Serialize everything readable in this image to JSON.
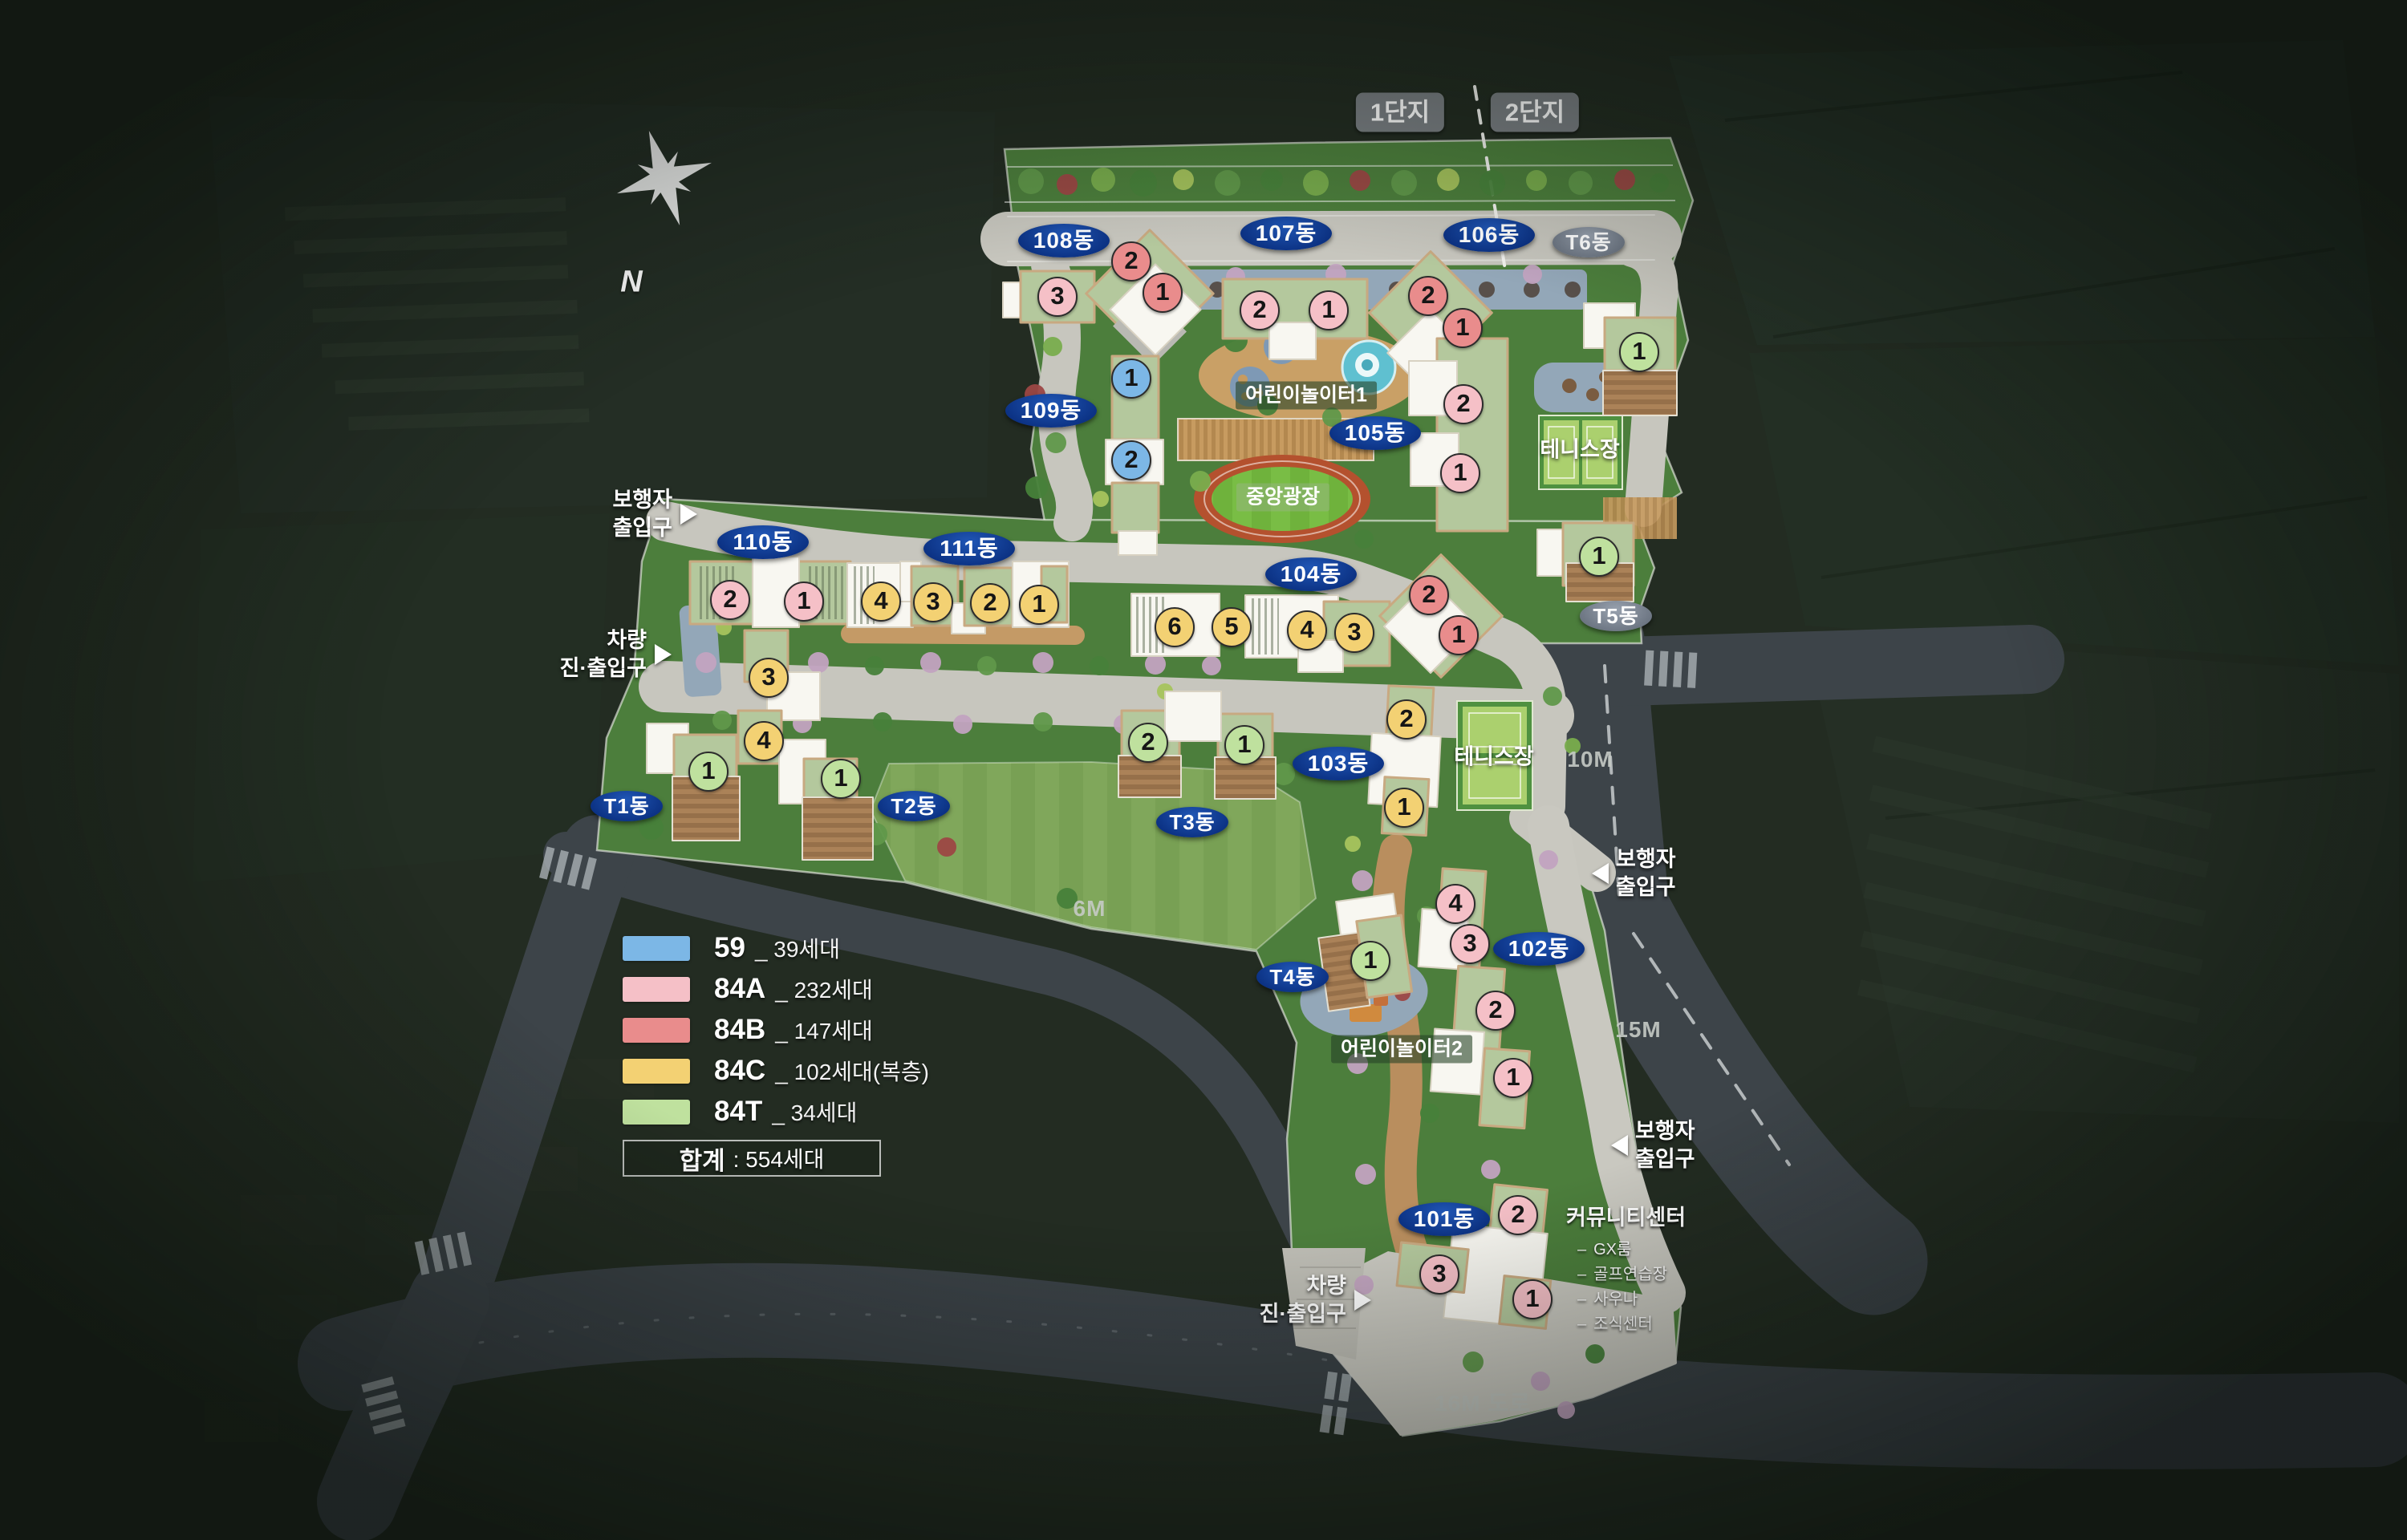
{
  "complex_tags": {
    "tag1": "1단지",
    "tag2": "2단지"
  },
  "compass": {
    "north": "N"
  },
  "buildings": [
    {
      "label": "101동",
      "units": [
        {
          "n": "2",
          "t": "84A"
        },
        {
          "n": "3",
          "t": "84A"
        },
        {
          "n": "1",
          "t": "84A"
        }
      ]
    },
    {
      "label": "102동",
      "units": [
        {
          "n": "4",
          "t": "84A"
        },
        {
          "n": "3",
          "t": "84A"
        },
        {
          "n": "2",
          "t": "84A"
        },
        {
          "n": "1",
          "t": "84A"
        }
      ]
    },
    {
      "label": "103동",
      "units": [
        {
          "n": "2",
          "t": "84C"
        },
        {
          "n": "1",
          "t": "84C"
        }
      ]
    },
    {
      "label": "104동",
      "units": [
        {
          "n": "6",
          "t": "84C"
        },
        {
          "n": "5",
          "t": "84C"
        },
        {
          "n": "4",
          "t": "84C"
        },
        {
          "n": "3",
          "t": "84C"
        },
        {
          "n": "2",
          "t": "84B"
        },
        {
          "n": "1",
          "t": "84B"
        }
      ]
    },
    {
      "label": "105동",
      "units": [
        {
          "n": "2",
          "t": "84A"
        },
        {
          "n": "1",
          "t": "84A"
        }
      ]
    },
    {
      "label": "106동",
      "units": [
        {
          "n": "2",
          "t": "84B"
        },
        {
          "n": "1",
          "t": "84B"
        }
      ]
    },
    {
      "label": "107동",
      "units": [
        {
          "n": "2",
          "t": "84A"
        },
        {
          "n": "1",
          "t": "84A"
        }
      ]
    },
    {
      "label": "108동",
      "units": [
        {
          "n": "3",
          "t": "84A"
        },
        {
          "n": "2",
          "t": "84B"
        },
        {
          "n": "1",
          "t": "84B"
        }
      ]
    },
    {
      "label": "109동",
      "units": [
        {
          "n": "1",
          "t": "59"
        },
        {
          "n": "2",
          "t": "59"
        }
      ]
    },
    {
      "label": "110동",
      "units": [
        {
          "n": "2",
          "t": "84A"
        },
        {
          "n": "1",
          "t": "84A"
        },
        {
          "n": "3",
          "t": "84C"
        },
        {
          "n": "4",
          "t": "84C"
        }
      ]
    },
    {
      "label": "111동",
      "units": [
        {
          "n": "4",
          "t": "84C"
        },
        {
          "n": "3",
          "t": "84C"
        },
        {
          "n": "2",
          "t": "84C"
        },
        {
          "n": "1",
          "t": "84C"
        }
      ]
    },
    {
      "label": "T1동",
      "units": [
        {
          "n": "1",
          "t": "84T"
        }
      ]
    },
    {
      "label": "T2동",
      "units": [
        {
          "n": "1",
          "t": "84T"
        }
      ]
    },
    {
      "label": "T3동",
      "units": [
        {
          "n": "2",
          "t": "84T"
        },
        {
          "n": "1",
          "t": "84T"
        }
      ]
    },
    {
      "label": "T4동",
      "units": [
        {
          "n": "1",
          "t": "84T"
        }
      ]
    },
    {
      "label": "T5동",
      "units": [
        {
          "n": "1",
          "t": "84T"
        }
      ]
    },
    {
      "label": "T6동",
      "units": [
        {
          "n": "1",
          "t": "84T"
        }
      ]
    }
  ],
  "facilities": {
    "playground1": "어린이놀이터1",
    "playground2": "어린이놀이터2",
    "central_plaza": "중앙광장",
    "tennis_top": "테니스장",
    "tennis_mid": "테니스장",
    "community": {
      "title": "커뮤니티센터",
      "item_prefix": "–",
      "items": [
        "GX룸",
        "골프연습장",
        "사우나",
        "조식센터"
      ]
    }
  },
  "entrances": {
    "pedestrian_left": "보행자\n출입구",
    "vehicle_left": "차량\n진·출입구",
    "pedestrian_right_upper": "보행자\n출입구",
    "pedestrian_right_lower": "보행자\n출입구",
    "vehicle_bottom": "차량\n진·출입구"
  },
  "roads": {
    "r6": "6M",
    "r10": "10M",
    "r15": "15M",
    "r16": "16M 도로"
  },
  "legend": {
    "items": [
      {
        "code": "59",
        "suffix": "_ 39세대",
        "color": "#7cb7e6",
        "type": "59"
      },
      {
        "code": "84A",
        "suffix": "_ 232세대",
        "color": "#f5c0c7",
        "type": "84A"
      },
      {
        "code": "84B",
        "suffix": "_ 147세대",
        "color": "#e98c8c",
        "type": "84B"
      },
      {
        "code": "84C",
        "suffix": "_ 102세대(복층)",
        "color": "#f3d173",
        "type": "84C"
      },
      {
        "code": "84T",
        "suffix": "_ 34세대",
        "color": "#bfe19e",
        "type": "84T"
      }
    ],
    "total_label": "합계",
    "total_separator": ":",
    "total_value": "554세대"
  }
}
